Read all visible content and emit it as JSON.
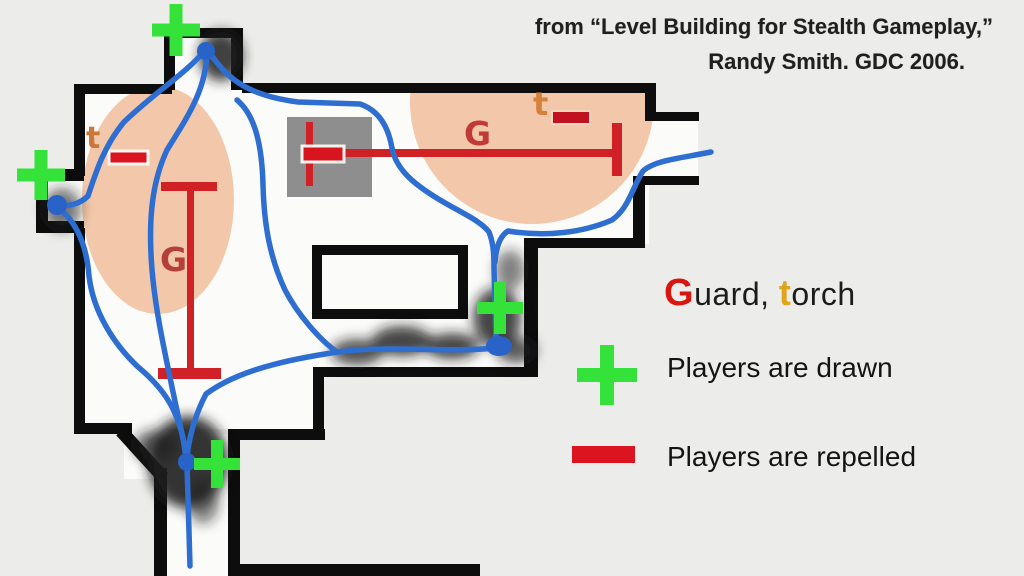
{
  "slide": {
    "attribution_line1": "from “Level Building for Stealth Gameplay,”",
    "attribution_line2": "Randy Smith. GDC 2006."
  },
  "legend": {
    "guard_initial": "G",
    "guard_rest": "uard, ",
    "torch_initial": "t",
    "torch_rest": "orch",
    "drawn_icon": "plus-icon",
    "drawn_label": "Players are drawn",
    "repelled_icon": "minus-icon",
    "repelled_label": "Players are repelled"
  },
  "map": {
    "labels": {
      "left_room_guard": "G",
      "left_room_torch": "t",
      "right_room_guard": "G",
      "right_room_torch": "t"
    },
    "icons": {
      "attraction_marker": "plus-icon",
      "repulsion_marker": "minus-icon",
      "path_node": "dot-icon"
    }
  },
  "colors": {
    "background": "#ecedeb",
    "floor": "#fbfbfa",
    "wall": "#0d0d0d",
    "torch_light": "#f3c7a9",
    "crate_gray": "#8e8e8e",
    "path_blue": "#2e6ed0",
    "node_blue": "#2a63c8",
    "drawn_green": "#35e239",
    "repelled_red": "#dc1420",
    "beam_red": "#cf2126",
    "guard_letter_red": "#b5403a",
    "torch_letter_orange": "#c9773a",
    "legend_guard_red": "#d9150f",
    "legend_torch_gold": "#dfa51a",
    "text_dark": "#1f1f1f"
  }
}
